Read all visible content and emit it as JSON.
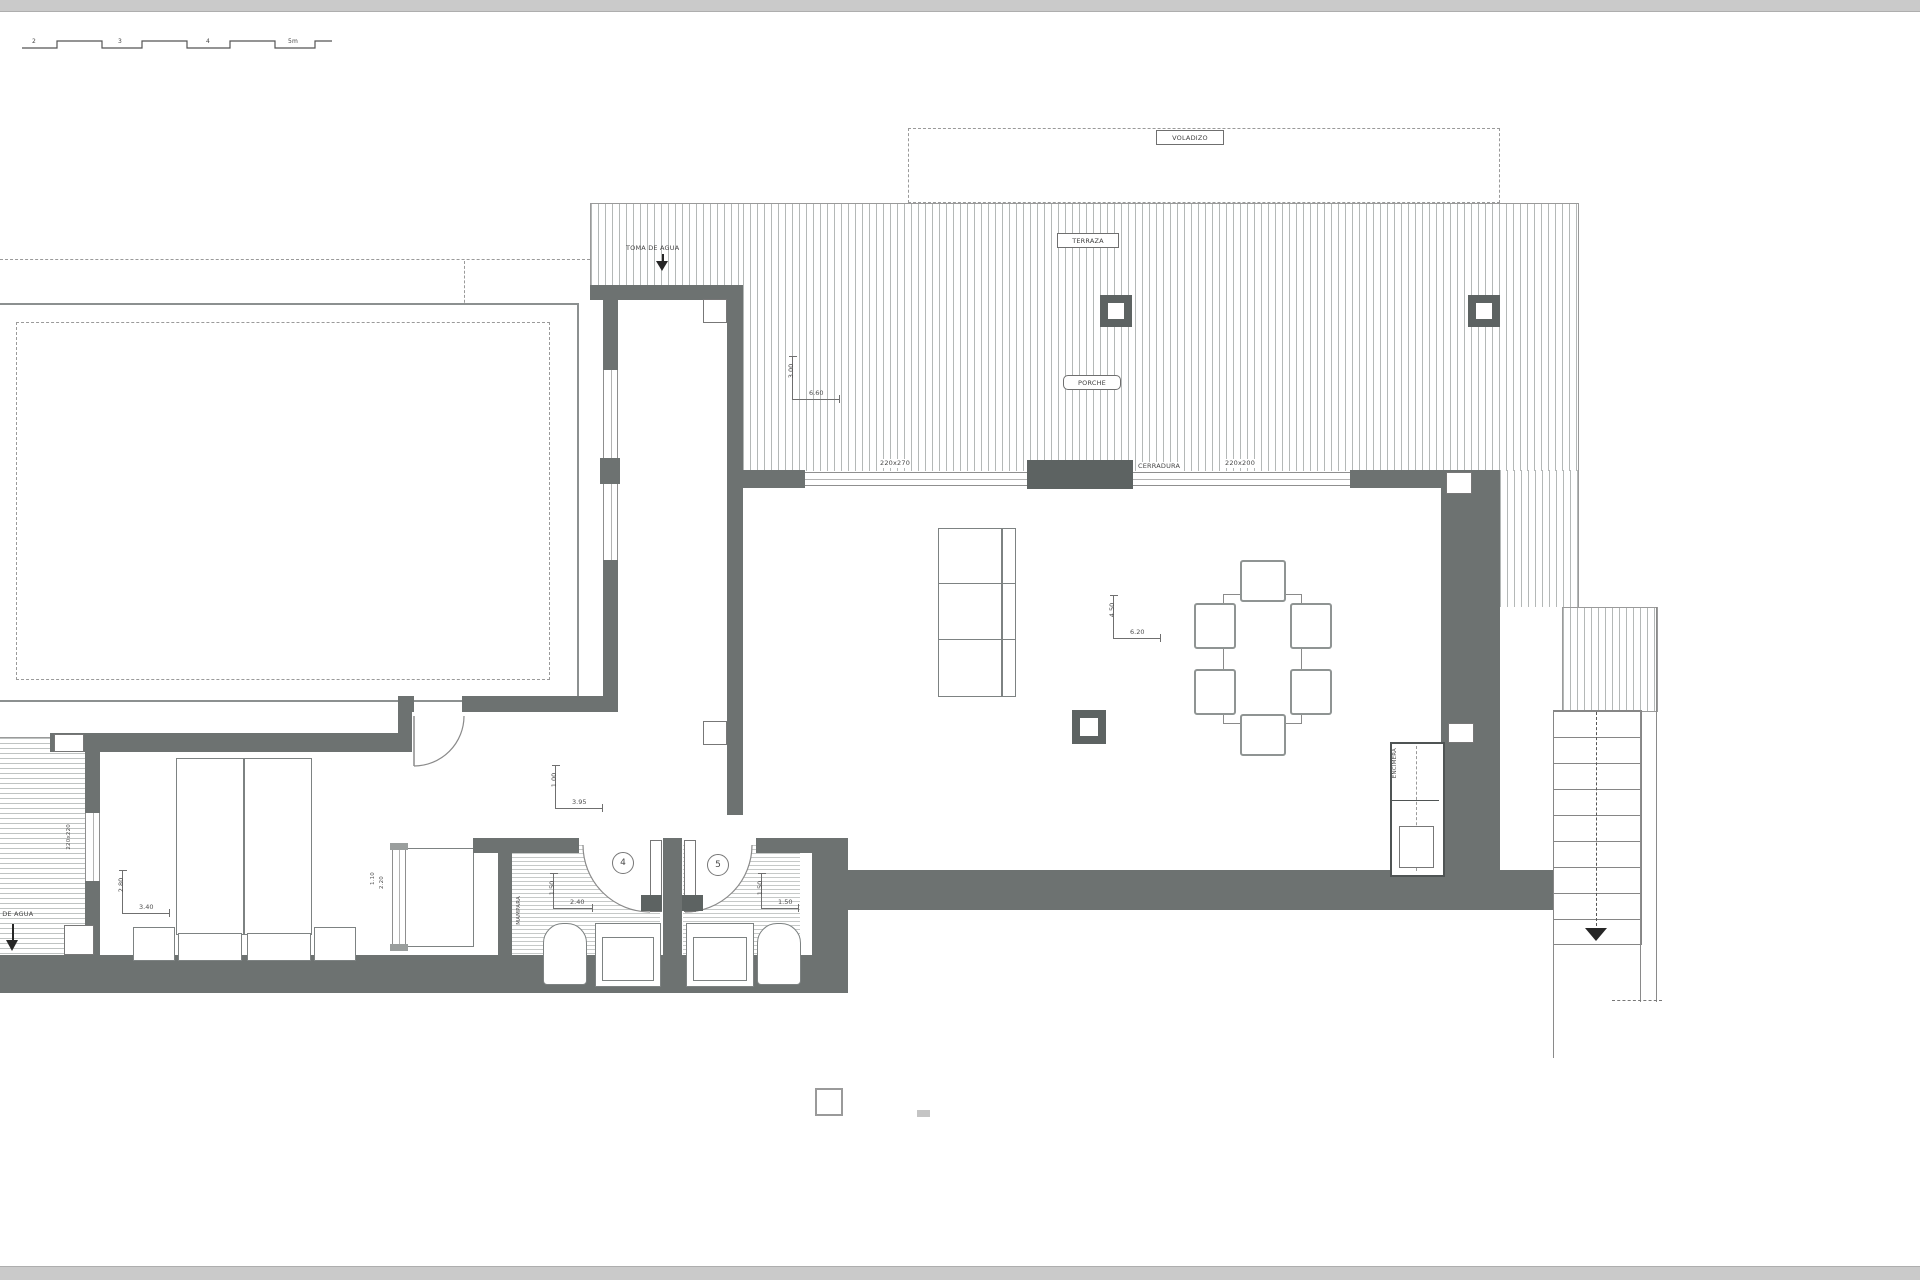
{
  "drawing": {
    "scalebar": {
      "ticks": [
        "2",
        "3",
        "4",
        "5m"
      ]
    },
    "zones": {
      "voladizo": "VOLADIZO",
      "terraza": "TERRAZA",
      "porche": "PORCHE"
    },
    "annotations": {
      "toma_de_agua_top": "TOMA DE AGUA",
      "toma_de_agua_left": "TOMA DE AGUA",
      "motores": "MOTORES",
      "cerradura": "CERRADURA",
      "mampara": "MAMPARA",
      "encimera": "ENCIMERA",
      "win_220x270": "220x270",
      "win_220x200": "220x200",
      "win_220x220": "220x220",
      "glass_1": "1.10",
      "glass_2": "2.20"
    },
    "room_numbers": {
      "bath4": "4",
      "bath5": "5"
    },
    "dimensions": {
      "porch": {
        "v": "3.00",
        "h": "6.60"
      },
      "living": {
        "v": "4.50",
        "h": "6.20"
      },
      "hall": {
        "v": "1.00",
        "h": "3.95"
      },
      "bedroom": {
        "v": "2.80",
        "h": "3.40"
      },
      "bath4": {
        "v": "1.50",
        "h": "2.40"
      },
      "bath5": {
        "v": "1.50",
        "h": "1.50"
      }
    },
    "colors": {
      "wall": "#6d7271",
      "line": "#8a8a8a",
      "hatch": "#b4b8b7",
      "text": "#454545"
    }
  }
}
